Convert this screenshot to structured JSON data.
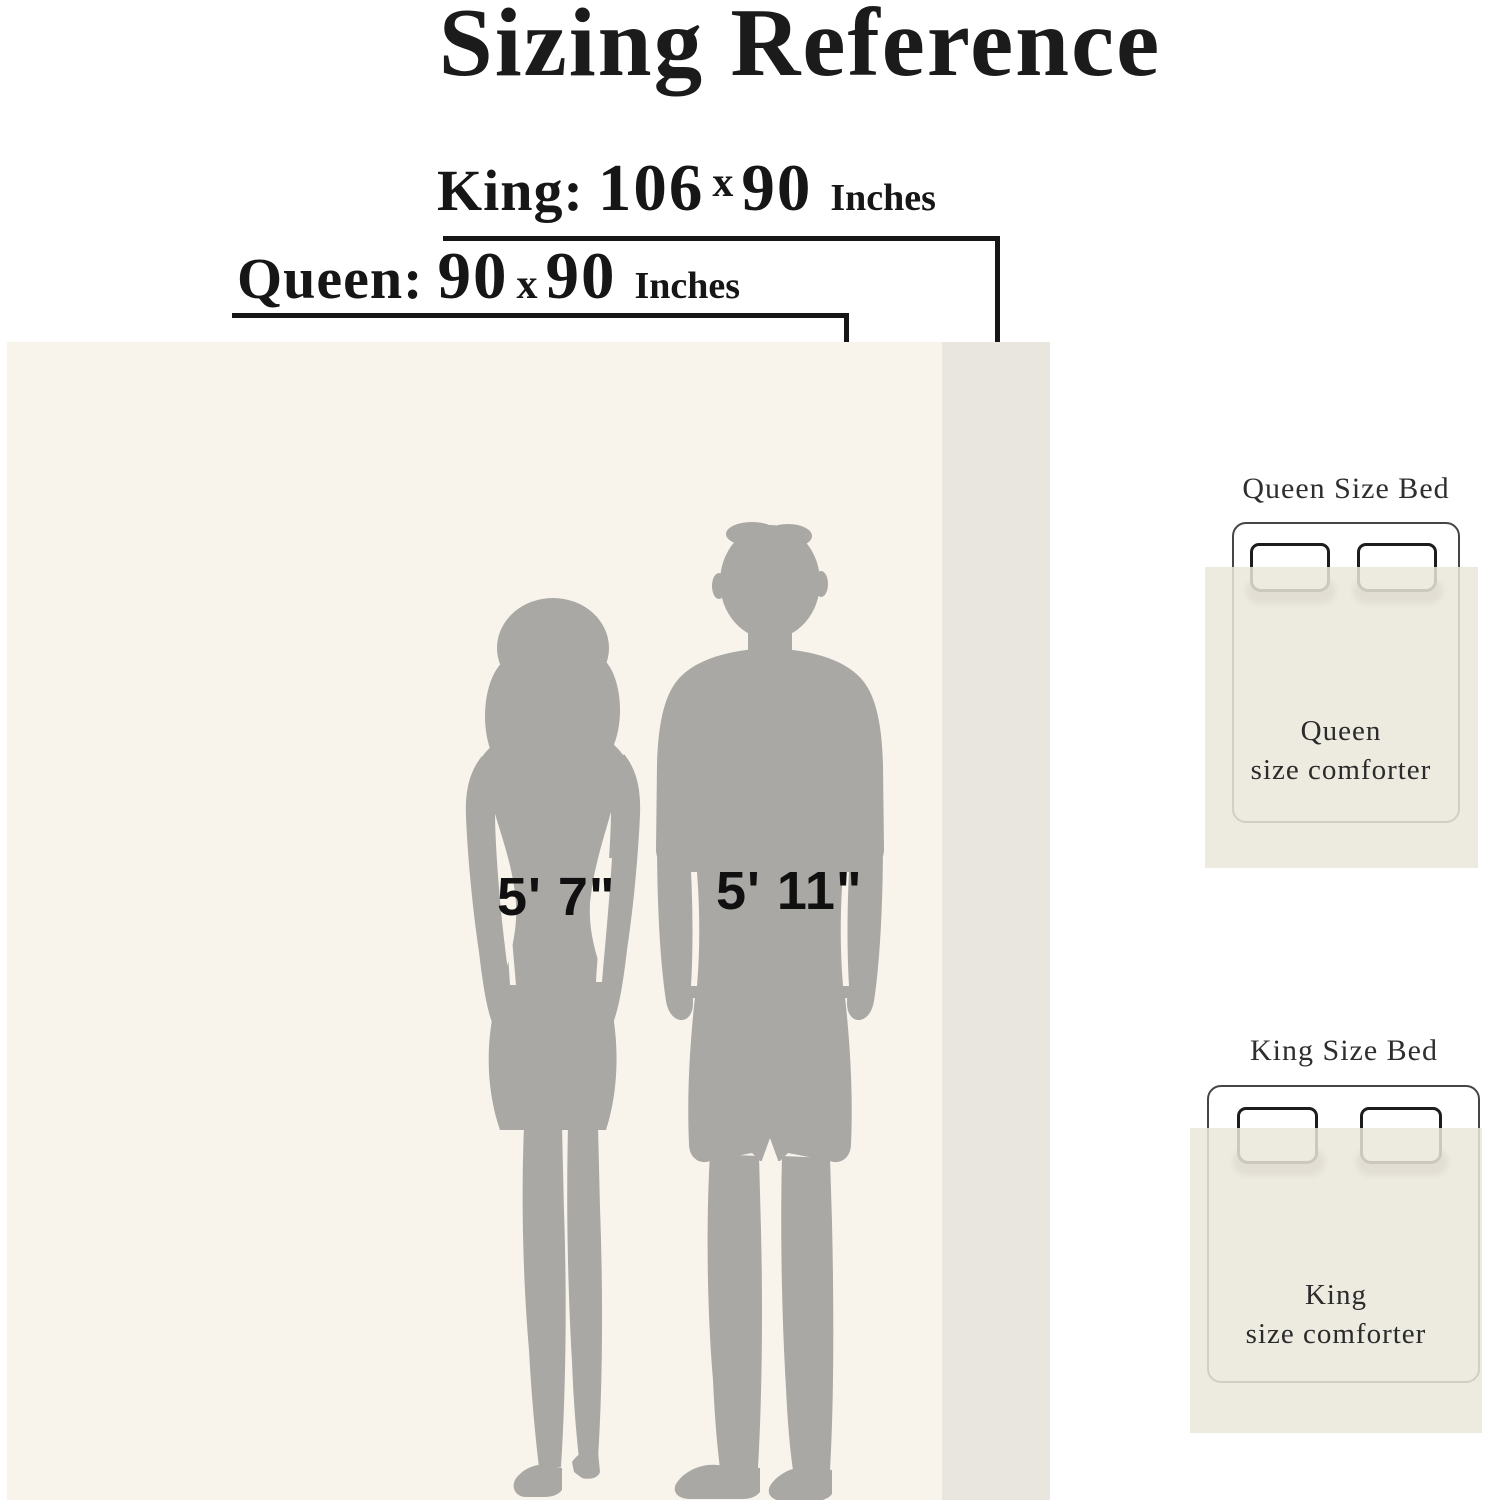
{
  "title": "Sizing Reference",
  "labels": {
    "king": {
      "name": "King:",
      "width": "106",
      "multiply": "x",
      "height": "90",
      "unit": "Inches"
    },
    "queen": {
      "name": "Queen:",
      "width": "90",
      "multiply": "x",
      "height": "90",
      "unit": "Inches"
    }
  },
  "figures": {
    "woman_height": "5' 7\"",
    "man_height": "5' 11\""
  },
  "beds": [
    {
      "title": "Queen Size Bed",
      "line1": "Queen",
      "line2": "size comforter"
    },
    {
      "title": "King Size Bed",
      "line1": "King",
      "line2": "size comforter"
    }
  ],
  "icons": {
    "woman": "woman-silhouette",
    "man": "man-silhouette",
    "pillow": "pillow-icon"
  },
  "colors": {
    "queen_panel": "#f8f4ec",
    "king_strip": "#e9e6df",
    "silhouette": "#a9a8a5",
    "diagram_comforter": "#eae6db",
    "line": "#161616"
  }
}
